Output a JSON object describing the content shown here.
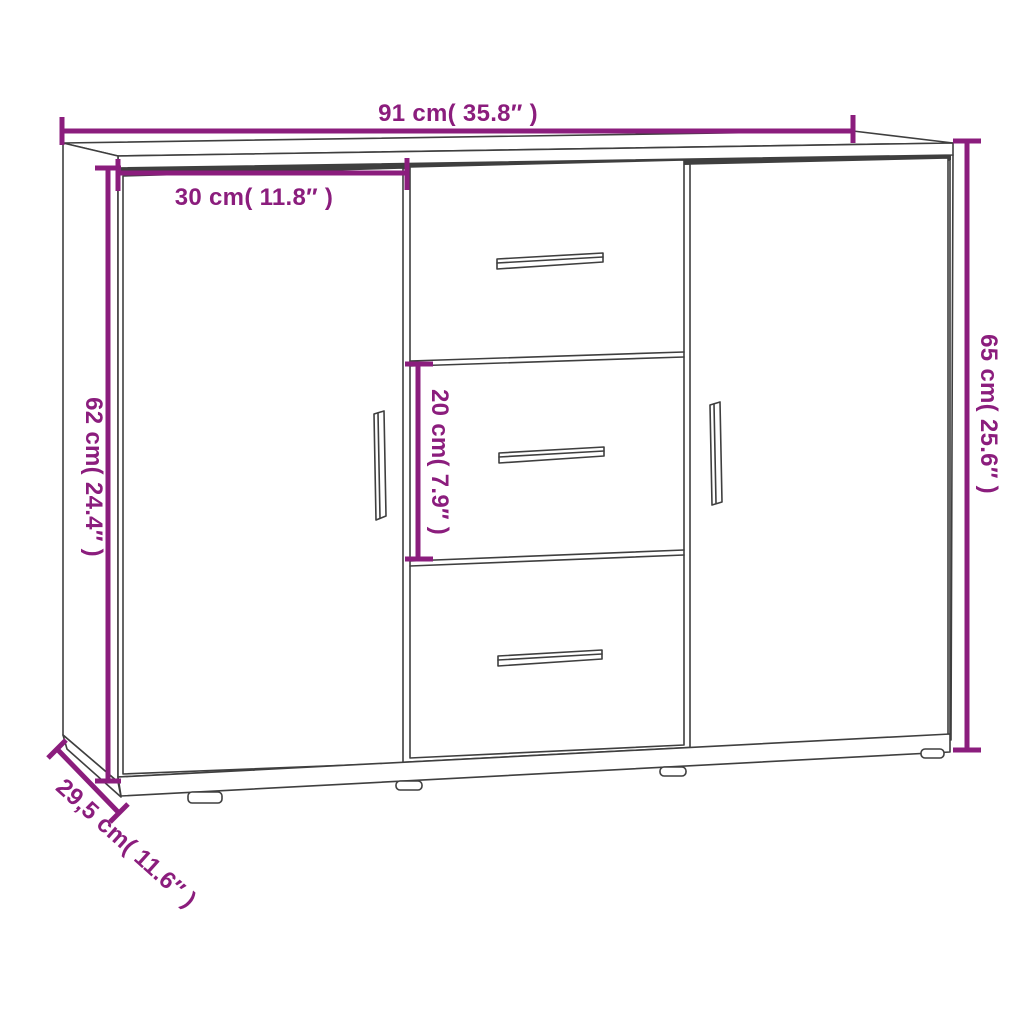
{
  "colors": {
    "dimension": "#8B1D7D",
    "outline": "#3f3f3f",
    "background": "#ffffff"
  },
  "labels": {
    "overall_width": "91 cm( 35.8″ )",
    "door_width": "30 cm( 11.8″ )",
    "door_height": "62 cm( 24.4″ )",
    "drawer_height": "20 cm( 7.9″ )",
    "overall_height": "65 cm( 25.6″ )",
    "depth": "29,5 cm( 11.6″ )"
  }
}
